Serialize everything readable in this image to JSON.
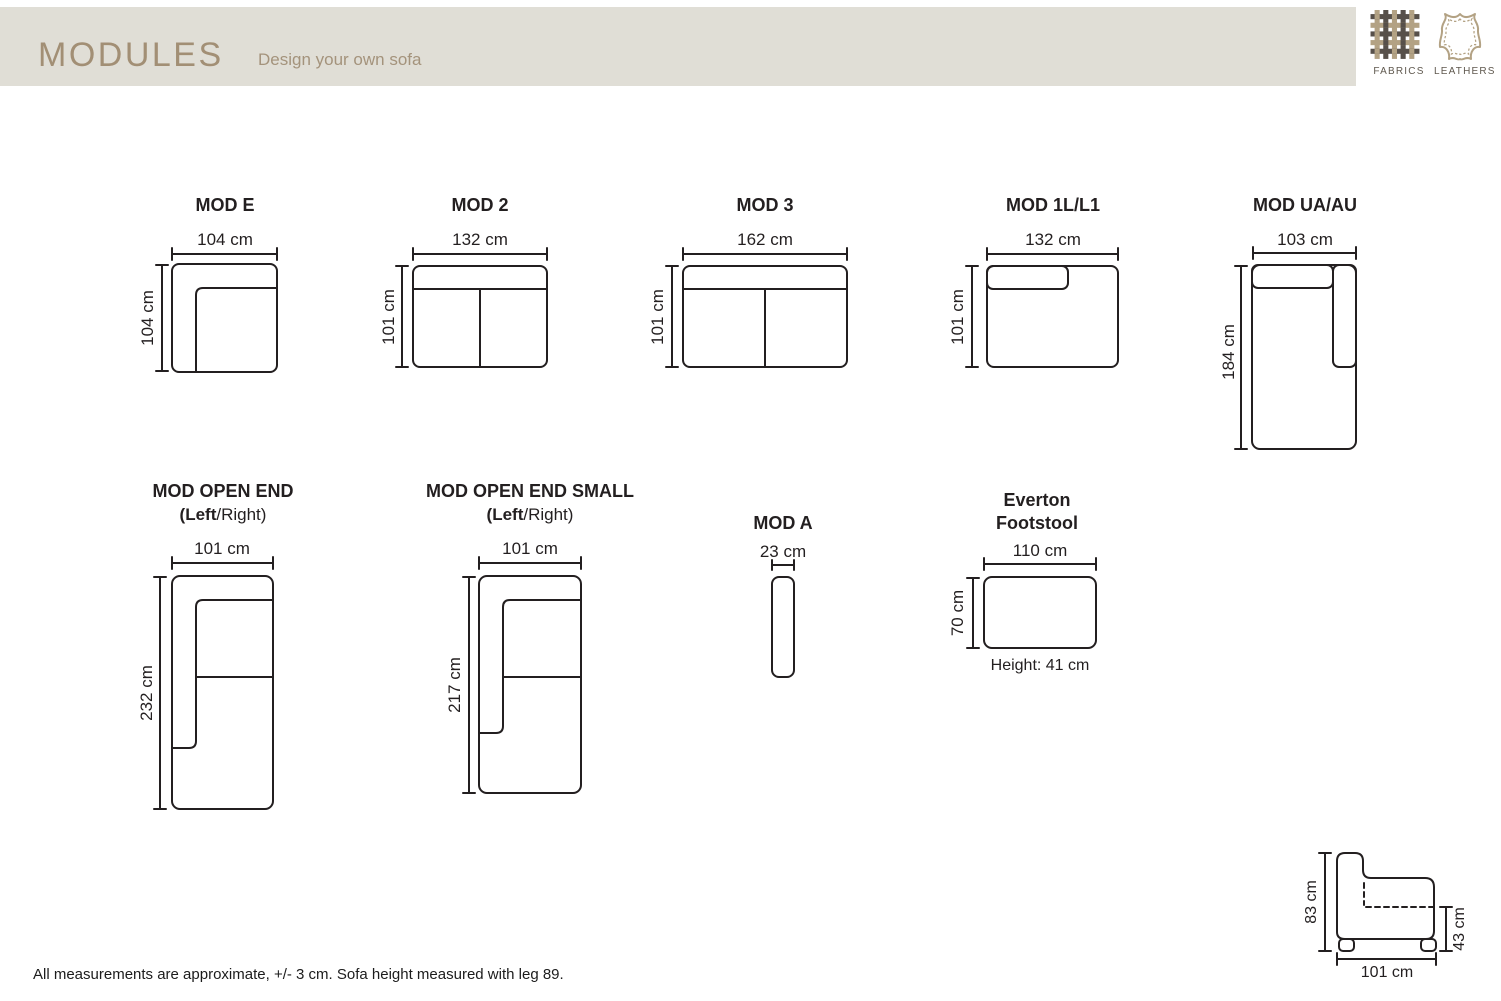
{
  "header": {
    "title": "MODULES",
    "subtitle": "Design your own sofa"
  },
  "materials": {
    "fabrics_label": "FABRICS",
    "leathers_label": "LEATHERS"
  },
  "modules": [
    {
      "title": "MOD E",
      "width": "104 cm",
      "height": "104 cm"
    },
    {
      "title": "MOD 2",
      "width": "132 cm",
      "height": "101 cm"
    },
    {
      "title": "MOD 3",
      "width": "162 cm",
      "height": "101 cm"
    },
    {
      "title": "MOD 1L/L1",
      "width": "132 cm",
      "height": "101 cm"
    },
    {
      "title": "MOD UA/AU",
      "width": "103 cm",
      "height": "184 cm"
    },
    {
      "title": "MOD OPEN END",
      "subtitle_bold": "(Left",
      "subtitle_rest": "/Right)",
      "width": "101 cm",
      "height": "232 cm"
    },
    {
      "title": "MOD OPEN END SMALL",
      "subtitle_bold": "(Left",
      "subtitle_rest": "/Right)",
      "width": "101 cm",
      "height": "217 cm"
    },
    {
      "title": "MOD A",
      "width": "23 cm"
    },
    {
      "title_line1": "Everton",
      "title_line2": "Footstool",
      "width": "110 cm",
      "height": "70 cm",
      "height_note": "Height: 41 cm"
    }
  ],
  "side_view": {
    "height": "83 cm",
    "seat_height": "43 cm",
    "depth": "101 cm"
  },
  "footer_note": "All measurements are approximate, +/- 3 cm. Sofa height measured with leg 89.",
  "colors": {
    "header_bar": "#e0ded6",
    "header_text": "#a28f75",
    "line": "#231f20",
    "fabric_dark": "#57504a",
    "fabric_tan": "#b3a284"
  }
}
